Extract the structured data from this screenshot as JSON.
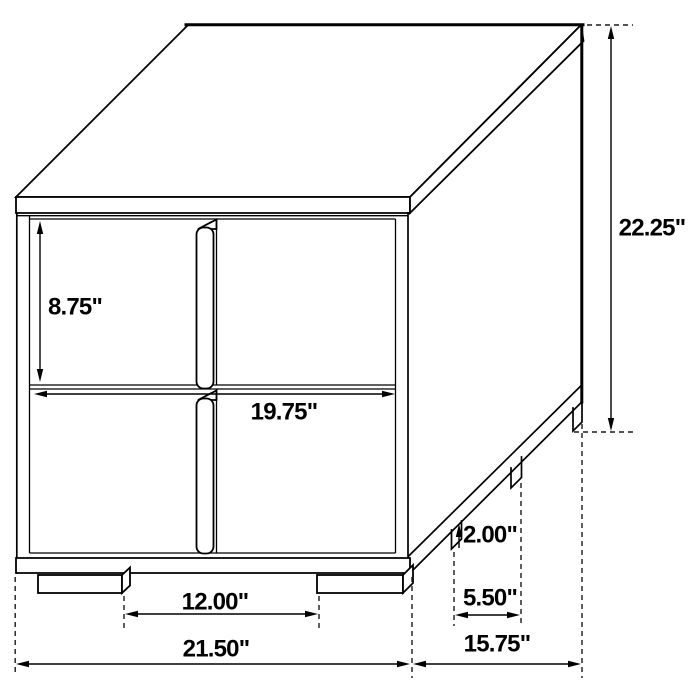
{
  "figure": {
    "kind": "furniture dimension diagram",
    "item": "two-drawer nightstand line drawing",
    "background_color": "#ffffff",
    "line_color": "#000000",
    "label_color": "#000000"
  },
  "labels": {
    "drawer_height": "8.75\"",
    "overall_height": "22.25\"",
    "drawer_width": "19.75\"",
    "front_leg_spacing": "12.00\"",
    "overall_width": "21.50\"",
    "leg_height": "2.00\"",
    "side_leg_spacing": "5.50\"",
    "overall_depth": "15.75\""
  }
}
